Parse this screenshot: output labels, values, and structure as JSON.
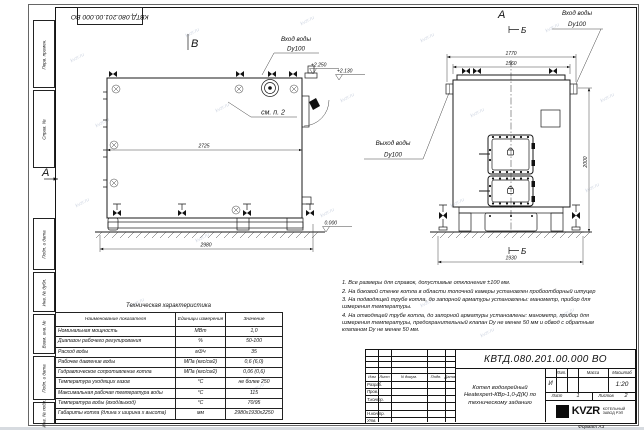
{
  "frame": {
    "top_doc_number": "КВТД.080.201.00.000 ВО",
    "side_labels": [
      "Перв. примен.",
      "Справ. №",
      "Подп. и дата",
      "Инв. № дубл.",
      "Взам. инв. №",
      "Подп. и дата",
      "Инв. № подл."
    ],
    "format_note": "Формат А3"
  },
  "views": {
    "side": {
      "label": "В",
      "view_arrow": "А",
      "inlet_label": "Вход воды",
      "inlet_size": "Dy100",
      "note_ref": "см. п. 2",
      "dim_length": "2725",
      "dim_length_overall": "2980",
      "elev_stub": "+2.250",
      "elev_valve": "+2.130",
      "elev_ground": "0.000"
    },
    "front": {
      "label": "А",
      "section_mark": "Б",
      "inlet_label": "Вход воды",
      "inlet_size": "Dy100",
      "outlet_label": "Выход воды",
      "outlet_size": "Dy100",
      "dim_overall_width": "1770",
      "dim_body_width": "1560",
      "dim_height": "2000",
      "dim_base_width": "1930"
    }
  },
  "tech_table": {
    "title": "Техническая характеристика",
    "headers": [
      "Наименование показателя",
      "Единицы измерения",
      "Значение"
    ],
    "rows": [
      [
        "Номинальная мощность",
        "МВт",
        "1,0"
      ],
      [
        "Диапазон рабочего регулирования",
        "%",
        "50-100"
      ],
      [
        "Расход воды",
        "м3/ч",
        "35"
      ],
      [
        "Рабочее давление воды",
        "МПа (кгс/см2)",
        "0,6 (6,0)"
      ],
      [
        "Гидравлическое сопротивление котла",
        "МПа (кгс/см2)",
        "0,06 (0,6)"
      ],
      [
        "Температура уходящих газов",
        "°С",
        "не более 250"
      ],
      [
        "Максимальная рабочая температура воды",
        "°С",
        "115"
      ],
      [
        "Температура воды (вход/выход)",
        "°С",
        "70/95"
      ],
      [
        "Габариты котла (длина х ширина х высота)",
        "мм",
        "2980х1930х2250"
      ]
    ]
  },
  "notes": [
    "1. Все размеры для справок, допустимые отклонения ±100 мм.",
    "2. На боковой стенке котла в области топочной камеры установлен пробоотборный штуцер",
    "3. На подводящей трубе котла, до запорной арматуры установлены: манометр, прибор для измерения температуры.",
    "4. На отводящей трубе котла, до запорной арматуры установлены: манометр, прибор для измерения температуры, предохранительный клапан Dу не менее 50 мм и обвод с обратным клапаном Dу не менее 50 мм."
  ],
  "title_block": {
    "doc_number": "КВТД.080.201.00.000  ВО",
    "product_name_lines": [
      "Котел водогрейный",
      "Heatexpert-КВр-1,0-Д(К) по",
      "техническому заданию"
    ],
    "header_cols": [
      "Изм",
      "Лист",
      "N докум.",
      "Подп.",
      "Дата"
    ],
    "row_labels": [
      "Разраб.",
      "Пров.",
      "Т.контр.",
      "Н.контр.",
      "Утв."
    ],
    "lit_label": "Лит.",
    "lit_value": "И",
    "mass_label": "Масса",
    "scale_label": "Масштаб",
    "scale_value": "1:20",
    "sheet_label": "Лист",
    "sheet_value": "1",
    "sheets_label": "Листов",
    "sheets_value": "2",
    "logo": "KVZR",
    "logo_sub1": "КОТЕЛЬНЫЙ",
    "logo_sub2": "ЗАВОД РЭП"
  },
  "watermark": {
    "text": "kvzr.ru",
    "positions": [
      [
        70,
        55
      ],
      [
        185,
        30
      ],
      [
        300,
        18
      ],
      [
        420,
        35
      ],
      [
        545,
        25
      ],
      [
        95,
        120
      ],
      [
        215,
        105
      ],
      [
        340,
        95
      ],
      [
        470,
        110
      ],
      [
        600,
        95
      ],
      [
        75,
        200
      ],
      [
        195,
        235
      ],
      [
        320,
        210
      ],
      [
        450,
        200
      ],
      [
        585,
        185
      ],
      [
        130,
        300
      ],
      [
        420,
        300
      ],
      [
        560,
        310
      ],
      [
        250,
        385
      ],
      [
        480,
        330
      ]
    ]
  }
}
